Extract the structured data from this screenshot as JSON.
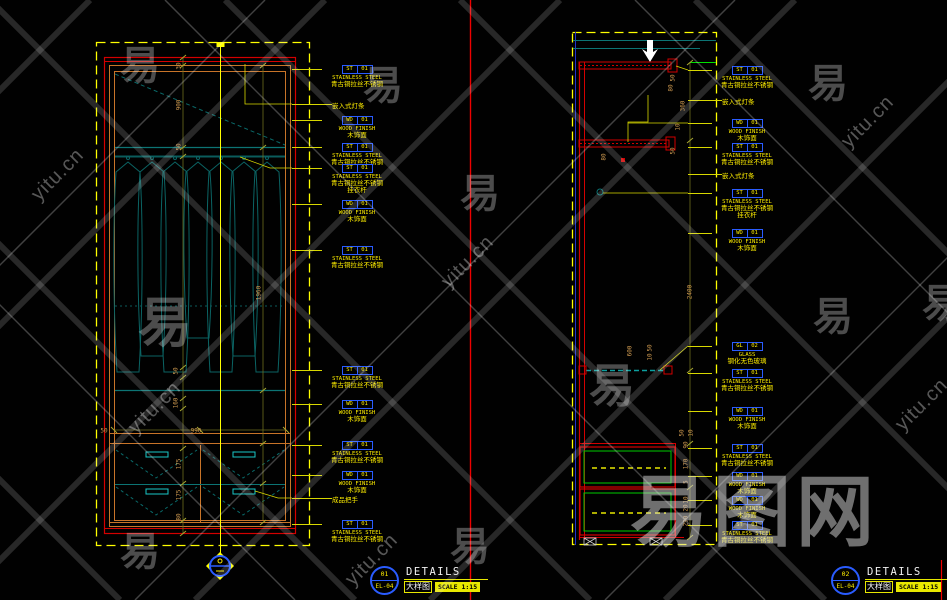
{
  "watermark": {
    "char": "易",
    "site": "yitu.cn",
    "brand": "易图网"
  },
  "wm_chars": [
    {
      "x": 140,
      "y": 62
    },
    {
      "x": 383,
      "y": 82
    },
    {
      "x": 828,
      "y": 80
    },
    {
      "x": 165,
      "y": 318,
      "s": 54
    },
    {
      "x": 480,
      "y": 190
    },
    {
      "x": 833,
      "y": 313
    },
    {
      "x": 612,
      "y": 383,
      "s": 46
    },
    {
      "x": 470,
      "y": 543
    },
    {
      "x": 140,
      "y": 548
    },
    {
      "x": 942,
      "y": 300
    }
  ],
  "wm_sites": [
    {
      "x": 155,
      "y": 408
    },
    {
      "x": 468,
      "y": 262
    },
    {
      "x": 868,
      "y": 122
    },
    {
      "x": 922,
      "y": 405
    },
    {
      "x": 372,
      "y": 560
    },
    {
      "x": 58,
      "y": 175
    }
  ],
  "left_panel": {
    "tags": [
      {
        "y": 65,
        "code": "ST",
        "num": "01",
        "name": "STAINLESS STEEL",
        "cn": "青古铜拉丝不锈钢"
      },
      {
        "y": 116,
        "code": "WD",
        "num": "01",
        "name": "WOOD FINISH",
        "cn": "木饰面"
      },
      {
        "y": 143,
        "code": "ST",
        "num": "01",
        "name": "STAINLESS STEEL",
        "cn": "青古铜拉丝不锈钢"
      },
      {
        "y": 164,
        "code": "ST",
        "num": "01",
        "name": "STAINLESS STEEL",
        "cn": "青古铜拉丝不锈钢",
        "extra": "挂衣杆"
      },
      {
        "y": 200,
        "code": "WD",
        "num": "01",
        "name": "WOOD FINISH",
        "cn": "木饰面"
      },
      {
        "y": 246,
        "code": "ST",
        "num": "01",
        "name": "STAINLESS STEEL",
        "cn": "青古铜拉丝不锈钢"
      },
      {
        "y": 366,
        "code": "ST",
        "num": "01",
        "name": "STAINLESS STEEL",
        "cn": "青古铜拉丝不锈钢"
      },
      {
        "y": 400,
        "code": "WD",
        "num": "01",
        "name": "WOOD FINISH",
        "cn": "木饰面"
      },
      {
        "y": 441,
        "code": "ST",
        "num": "01",
        "name": "STAINLESS STEEL",
        "cn": "青古铜拉丝不锈钢"
      },
      {
        "y": 471,
        "code": "WD",
        "num": "01",
        "name": "WOOD FINISH",
        "cn": "木饰面"
      },
      {
        "y": 520,
        "code": "ST",
        "num": "01",
        "name": "STAINLESS STEEL",
        "cn": "青古铜拉丝不锈钢"
      }
    ],
    "notes": [
      {
        "y": 100,
        "text": "嵌入式灯条"
      },
      {
        "y": 494,
        "text": "成品把手"
      }
    ],
    "dims": [
      {
        "x": 179,
        "y": 66,
        "v": "30"
      },
      {
        "x": 179,
        "y": 105,
        "v": "900"
      },
      {
        "x": 179,
        "y": 147,
        "v": "50"
      },
      {
        "x": 176,
        "y": 371,
        "v": "50"
      },
      {
        "x": 176,
        "y": 403,
        "v": "160"
      },
      {
        "x": 179,
        "y": 464,
        "v": "175"
      },
      {
        "x": 179,
        "y": 495,
        "v": "175"
      },
      {
        "x": 179,
        "y": 517,
        "v": "80"
      },
      {
        "x": 259,
        "y": 293,
        "v": "1960"
      },
      {
        "x": 104,
        "y": 431,
        "v": "50",
        "h": 1
      },
      {
        "x": 196,
        "y": 431,
        "v": "990",
        "h": 1
      }
    ]
  },
  "right_panel": {
    "tags": [
      {
        "y": 66,
        "code": "ST",
        "num": "01",
        "name": "STAINLESS STEEL",
        "cn": "青古铜拉丝不锈钢"
      },
      {
        "y": 119,
        "code": "WD",
        "num": "01",
        "name": "WOOD FINISH",
        "cn": "木饰面"
      },
      {
        "y": 143,
        "code": "ST",
        "num": "01",
        "name": "STAINLESS STEEL",
        "cn": "青古铜拉丝不锈钢"
      },
      {
        "y": 189,
        "code": "ST",
        "num": "01",
        "name": "STAINLESS STEEL",
        "cn": "青古铜拉丝不锈钢",
        "extra": "挂衣杆"
      },
      {
        "y": 229,
        "code": "WD",
        "num": "01",
        "name": "WOOD FINISH",
        "cn": "木饰面"
      },
      {
        "y": 342,
        "code": "GL",
        "num": "02",
        "name": "GLASS",
        "cn": "钢化无色玻璃"
      },
      {
        "y": 369,
        "code": "ST",
        "num": "01",
        "name": "STAINLESS STEEL",
        "cn": "青古铜拉丝不锈钢"
      },
      {
        "y": 407,
        "code": "WD",
        "num": "01",
        "name": "WOOD FINISH",
        "cn": "木饰面"
      },
      {
        "y": 444,
        "code": "ST",
        "num": "01",
        "name": "STAINLESS STEEL",
        "cn": "青古铜拉丝不锈钢"
      },
      {
        "y": 472,
        "code": "WD",
        "num": "01",
        "name": "WOOD FINISH",
        "cn": "木饰面"
      },
      {
        "y": 496,
        "code": "WD",
        "num": "01",
        "name": "WOOD FINISH",
        "cn": "木饰面"
      },
      {
        "y": 521,
        "code": "ST",
        "num": "01",
        "name": "STAINLESS STEEL",
        "cn": "青古铜拉丝不锈钢"
      }
    ],
    "notes": [
      {
        "y": 96,
        "text": "嵌入式灯条"
      },
      {
        "y": 170,
        "text": "嵌入式灯条"
      }
    ],
    "dims": [
      {
        "x": 673,
        "y": 78,
        "v": "50"
      },
      {
        "x": 671,
        "y": 88,
        "v": "80"
      },
      {
        "x": 683,
        "y": 106,
        "v": "360"
      },
      {
        "x": 678,
        "y": 127,
        "v": "10"
      },
      {
        "x": 673,
        "y": 151,
        "v": "50"
      },
      {
        "x": 604,
        "y": 157,
        "v": "80"
      },
      {
        "x": 690,
        "y": 292,
        "v": "2400"
      },
      {
        "x": 630,
        "y": 351,
        "v": "600"
      },
      {
        "x": 650,
        "y": 348,
        "v": "50"
      },
      {
        "x": 650,
        "y": 357,
        "v": "10"
      },
      {
        "x": 682,
        "y": 433,
        "v": "50"
      },
      {
        "x": 691,
        "y": 433,
        "v": "10"
      },
      {
        "x": 686,
        "y": 445,
        "v": "90"
      },
      {
        "x": 686,
        "y": 464,
        "v": "170"
      },
      {
        "x": 686,
        "y": 482,
        "v": "5"
      },
      {
        "x": 686,
        "y": 500,
        "v": "10"
      },
      {
        "x": 686,
        "y": 508,
        "v": "20"
      },
      {
        "x": 686,
        "y": 521,
        "v": "290"
      }
    ]
  },
  "title_blocks": [
    {
      "x": 370,
      "id": "01",
      "sheet": "EL-04",
      "title": "DETAILS",
      "cn": "大样图",
      "scale": "SCALE 1:15"
    },
    {
      "x": 831,
      "id": "02",
      "sheet": "EL-04",
      "title": "DETAILS",
      "cn": "大样图",
      "scale": "SCALE 1:15"
    }
  ]
}
